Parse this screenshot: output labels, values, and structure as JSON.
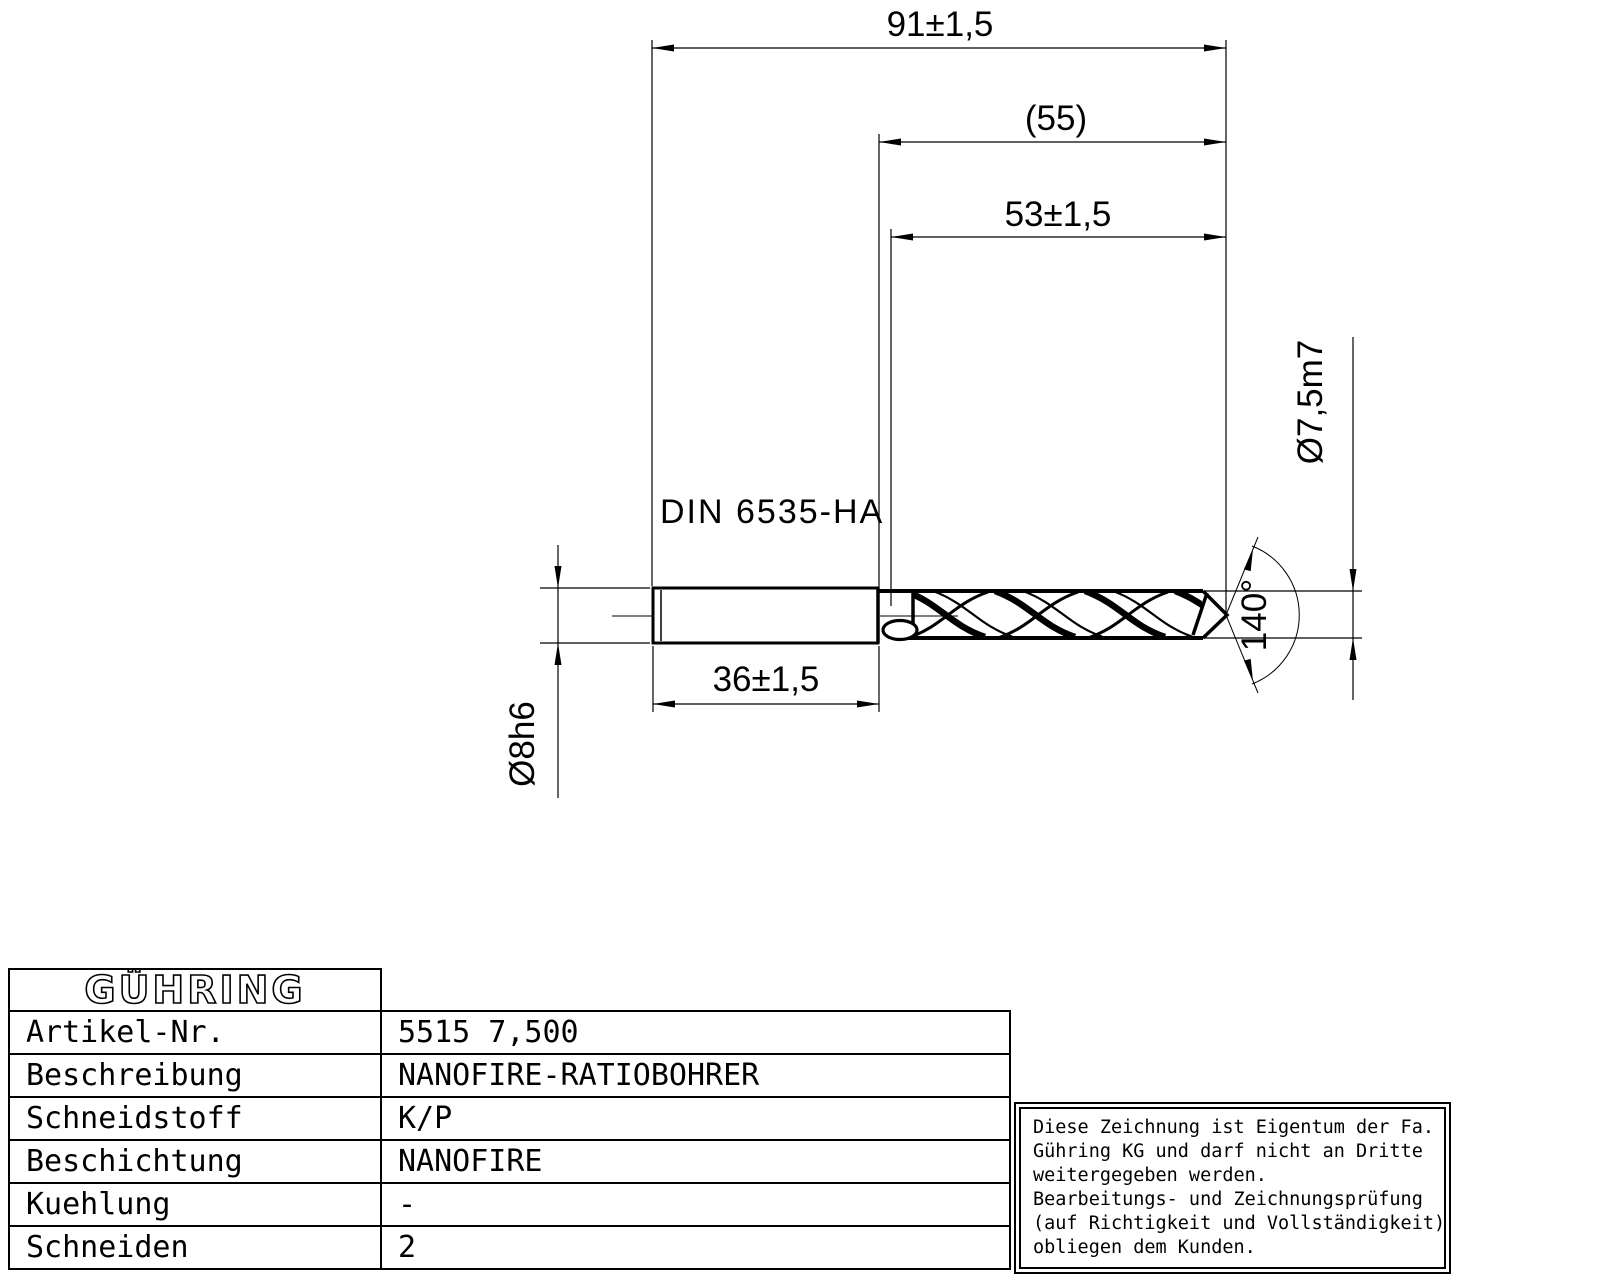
{
  "drawing": {
    "dim_total_length": "91±1,5",
    "dim_flute_ref": "(55)",
    "dim_flute_length": "53±1,5",
    "dim_shank_length": "36±1,5",
    "dim_drill_diameter": "Ø7,5m7",
    "dim_shank_diameter": "Ø8h6",
    "dim_point_angle": "140°",
    "shank_standard": "DIN 6535-HA"
  },
  "table": {
    "logo": "GÜHRING",
    "rows": [
      {
        "label": "Artikel-Nr.",
        "value": "5515 7,500"
      },
      {
        "label": "Beschreibung",
        "value": "NANOFIRE-RATIOBOHRER"
      },
      {
        "label": "Schneidstoff",
        "value": "K/P"
      },
      {
        "label": "Beschichtung",
        "value": "NANOFIRE"
      },
      {
        "label": "Kuehlung",
        "value": "-"
      },
      {
        "label": "Schneiden",
        "value": "2"
      }
    ]
  },
  "note": {
    "lines": [
      "Diese Zeichnung ist Eigentum der Fa.",
      "Gühring KG und darf nicht an Dritte",
      "weitergegeben werden.",
      "Bearbeitungs- und Zeichnungsprüfung",
      "(auf Richtigkeit und Vollständigkeit)",
      "obliegen dem Kunden."
    ]
  }
}
